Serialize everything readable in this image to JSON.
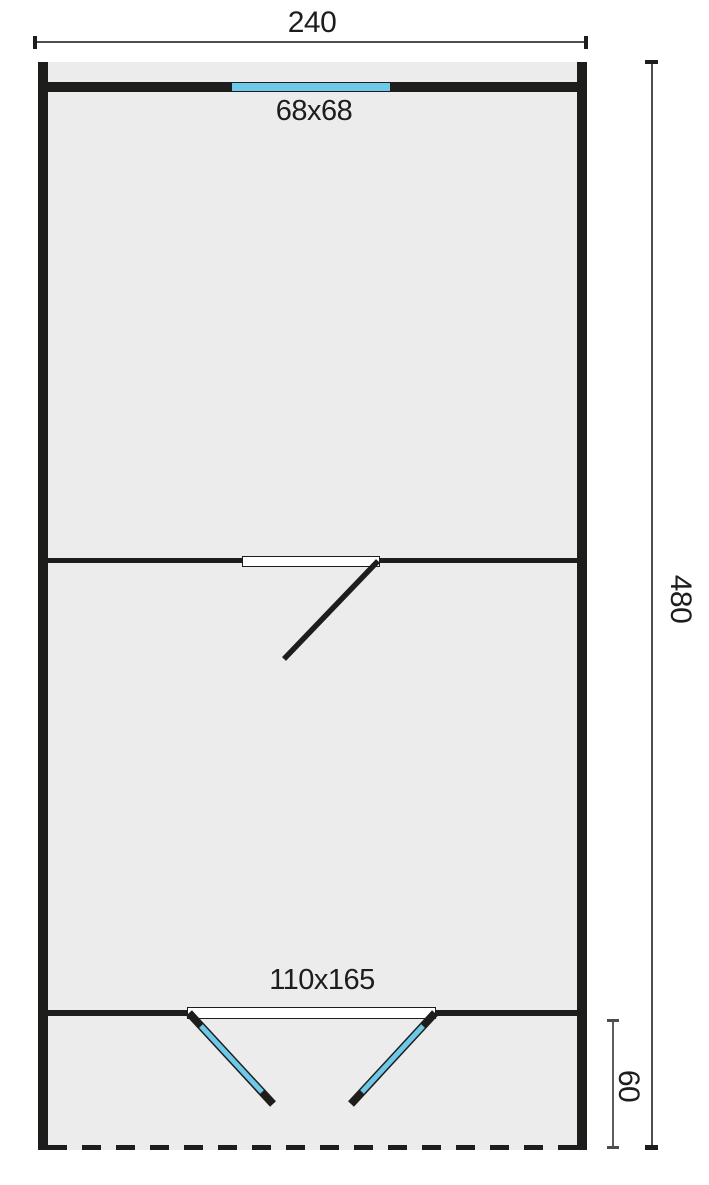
{
  "diagram": {
    "type": "cabin-floor-plan",
    "labels": {
      "total_width": "240",
      "total_depth": "480",
      "porch_depth": "60",
      "window_size": "68x68",
      "front_door_size": "110x165"
    },
    "colors": {
      "wall": "#1d1d1b",
      "floor_fill": "#ececec",
      "glazing_blue": "#6ec8e8",
      "dimension_line": "#4d4d4d",
      "background": "#ffffff"
    },
    "elements": [
      "rear wall window (blue glazing) labelled 68x68",
      "interior partition wall with single hinged door swing",
      "front wall with double doors (blue leaves) labelled 110x165",
      "open porch with dashed front edge, depth 60",
      "overall dimensions 240 wide by 480 deep"
    ]
  }
}
